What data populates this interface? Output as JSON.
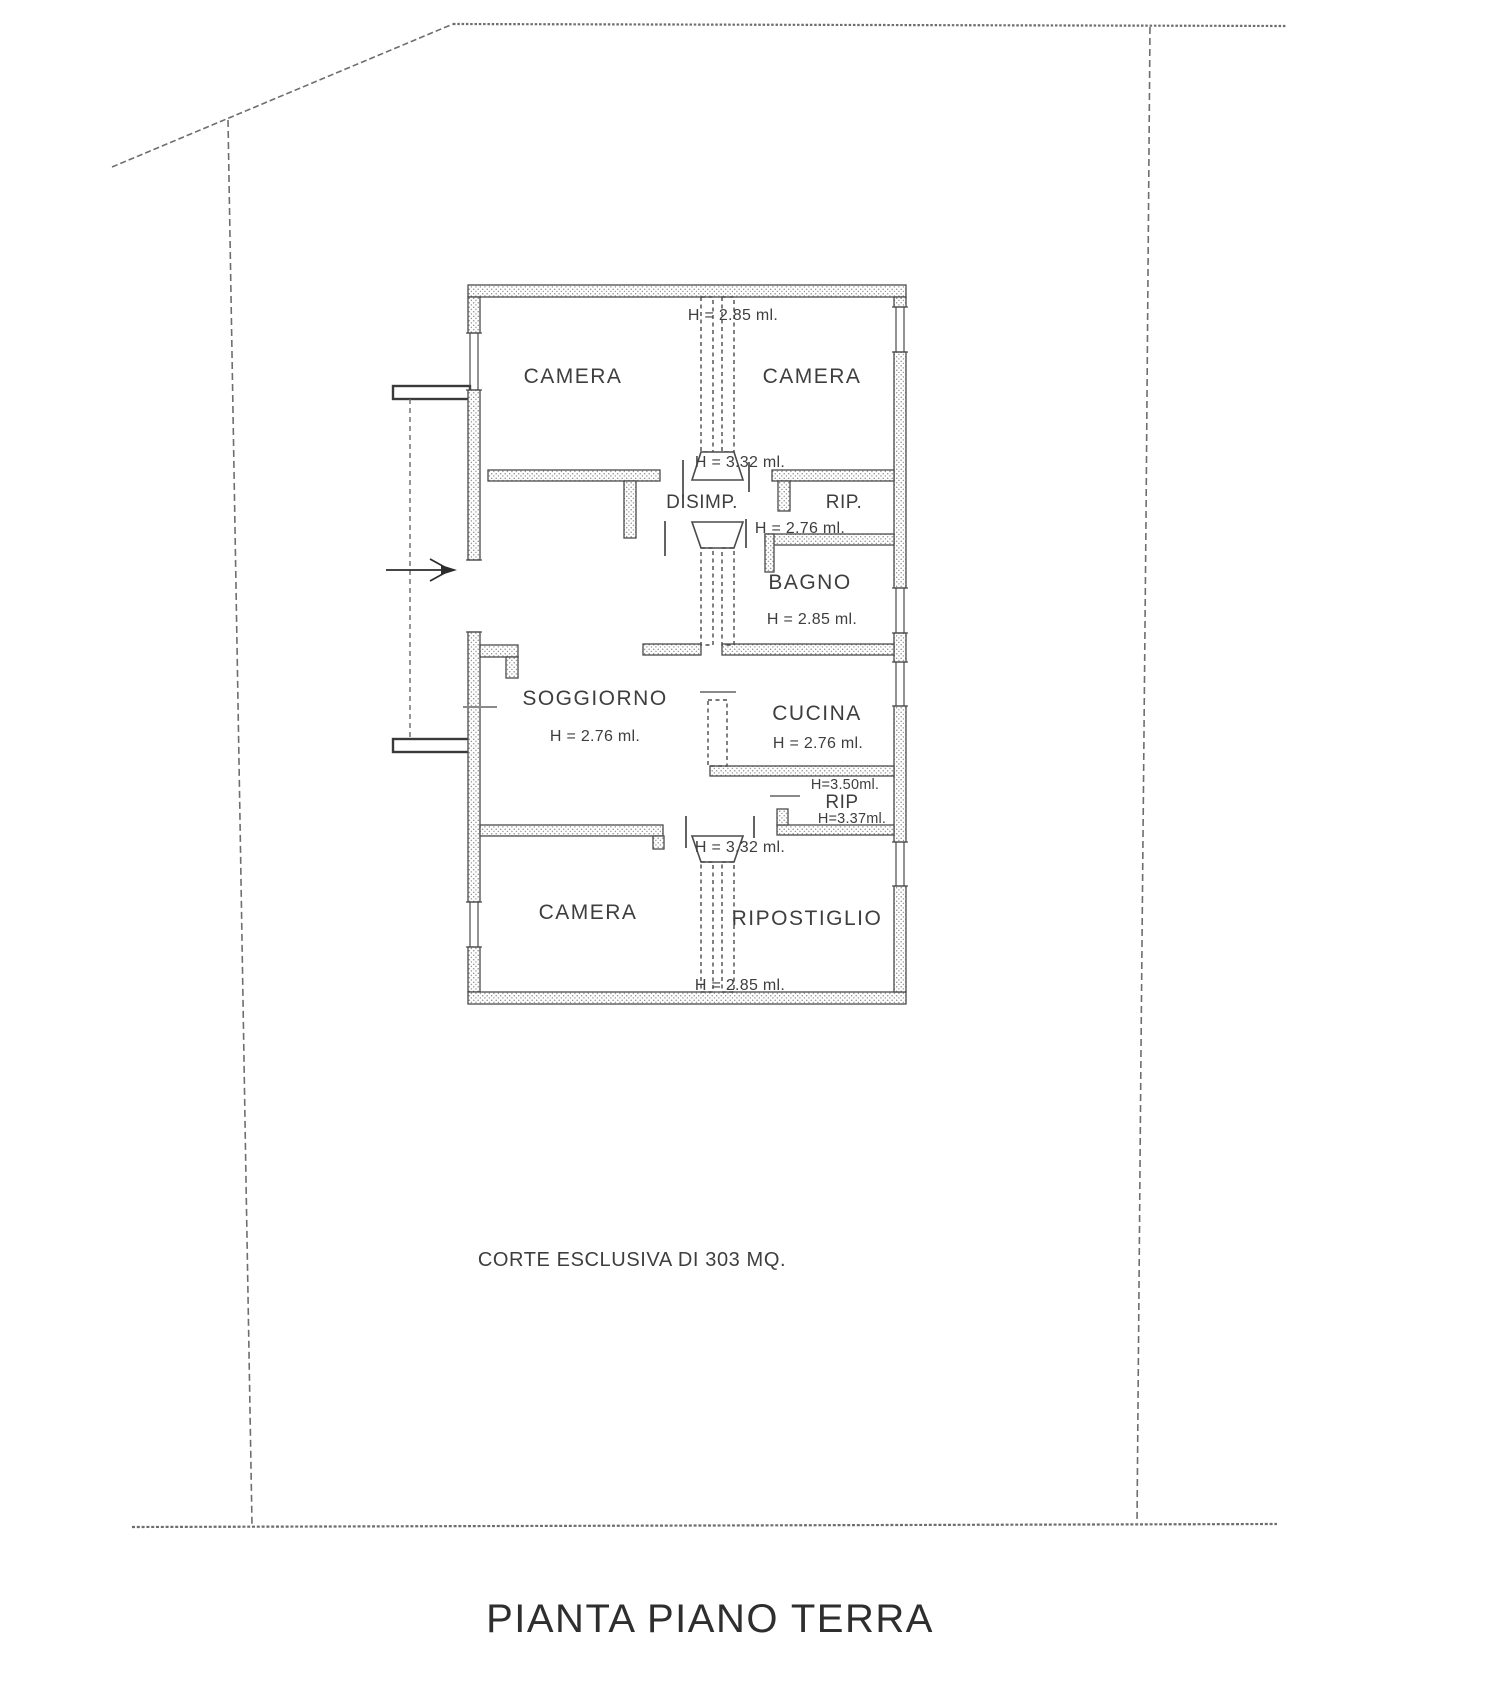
{
  "drawing": {
    "title": "PIANTA PIANO TERRA",
    "court_label": "CORTE ESCLUSIVA DI 303 MQ.",
    "type": "floor-plan",
    "line_color": "#4a4a4a",
    "text_color": "#3e3e3e",
    "background": "#ffffff"
  },
  "labels": {
    "camera_top_left": "CAMERA",
    "camera_top_right": "CAMERA",
    "disimpegno": "DISIMP.",
    "rip_top": "RIP.",
    "bagno": "BAGNO",
    "soggiorno": "SOGGIORNO",
    "cucina": "CUCINA",
    "rip_mid": "RIP",
    "camera_bottom": "CAMERA",
    "ripostiglio": "RIPOSTIGLIO"
  },
  "heights": {
    "top_shaft": "H = 2.85 ml.",
    "upper_shaft": "H = 3.32 ml.",
    "rip_top": "H = 2.76 ml.",
    "bagno": "H = 2.85 ml.",
    "soggiorno": "H = 2.76 ml.",
    "cucina": "H = 2.76 ml.",
    "rip_mid_upper": "H=3.50ml.",
    "rip_mid_lower": "H=3.37ml.",
    "lower_shaft": "H = 3.32 ml.",
    "bottom_shaft": "H = 2.85 ml."
  }
}
